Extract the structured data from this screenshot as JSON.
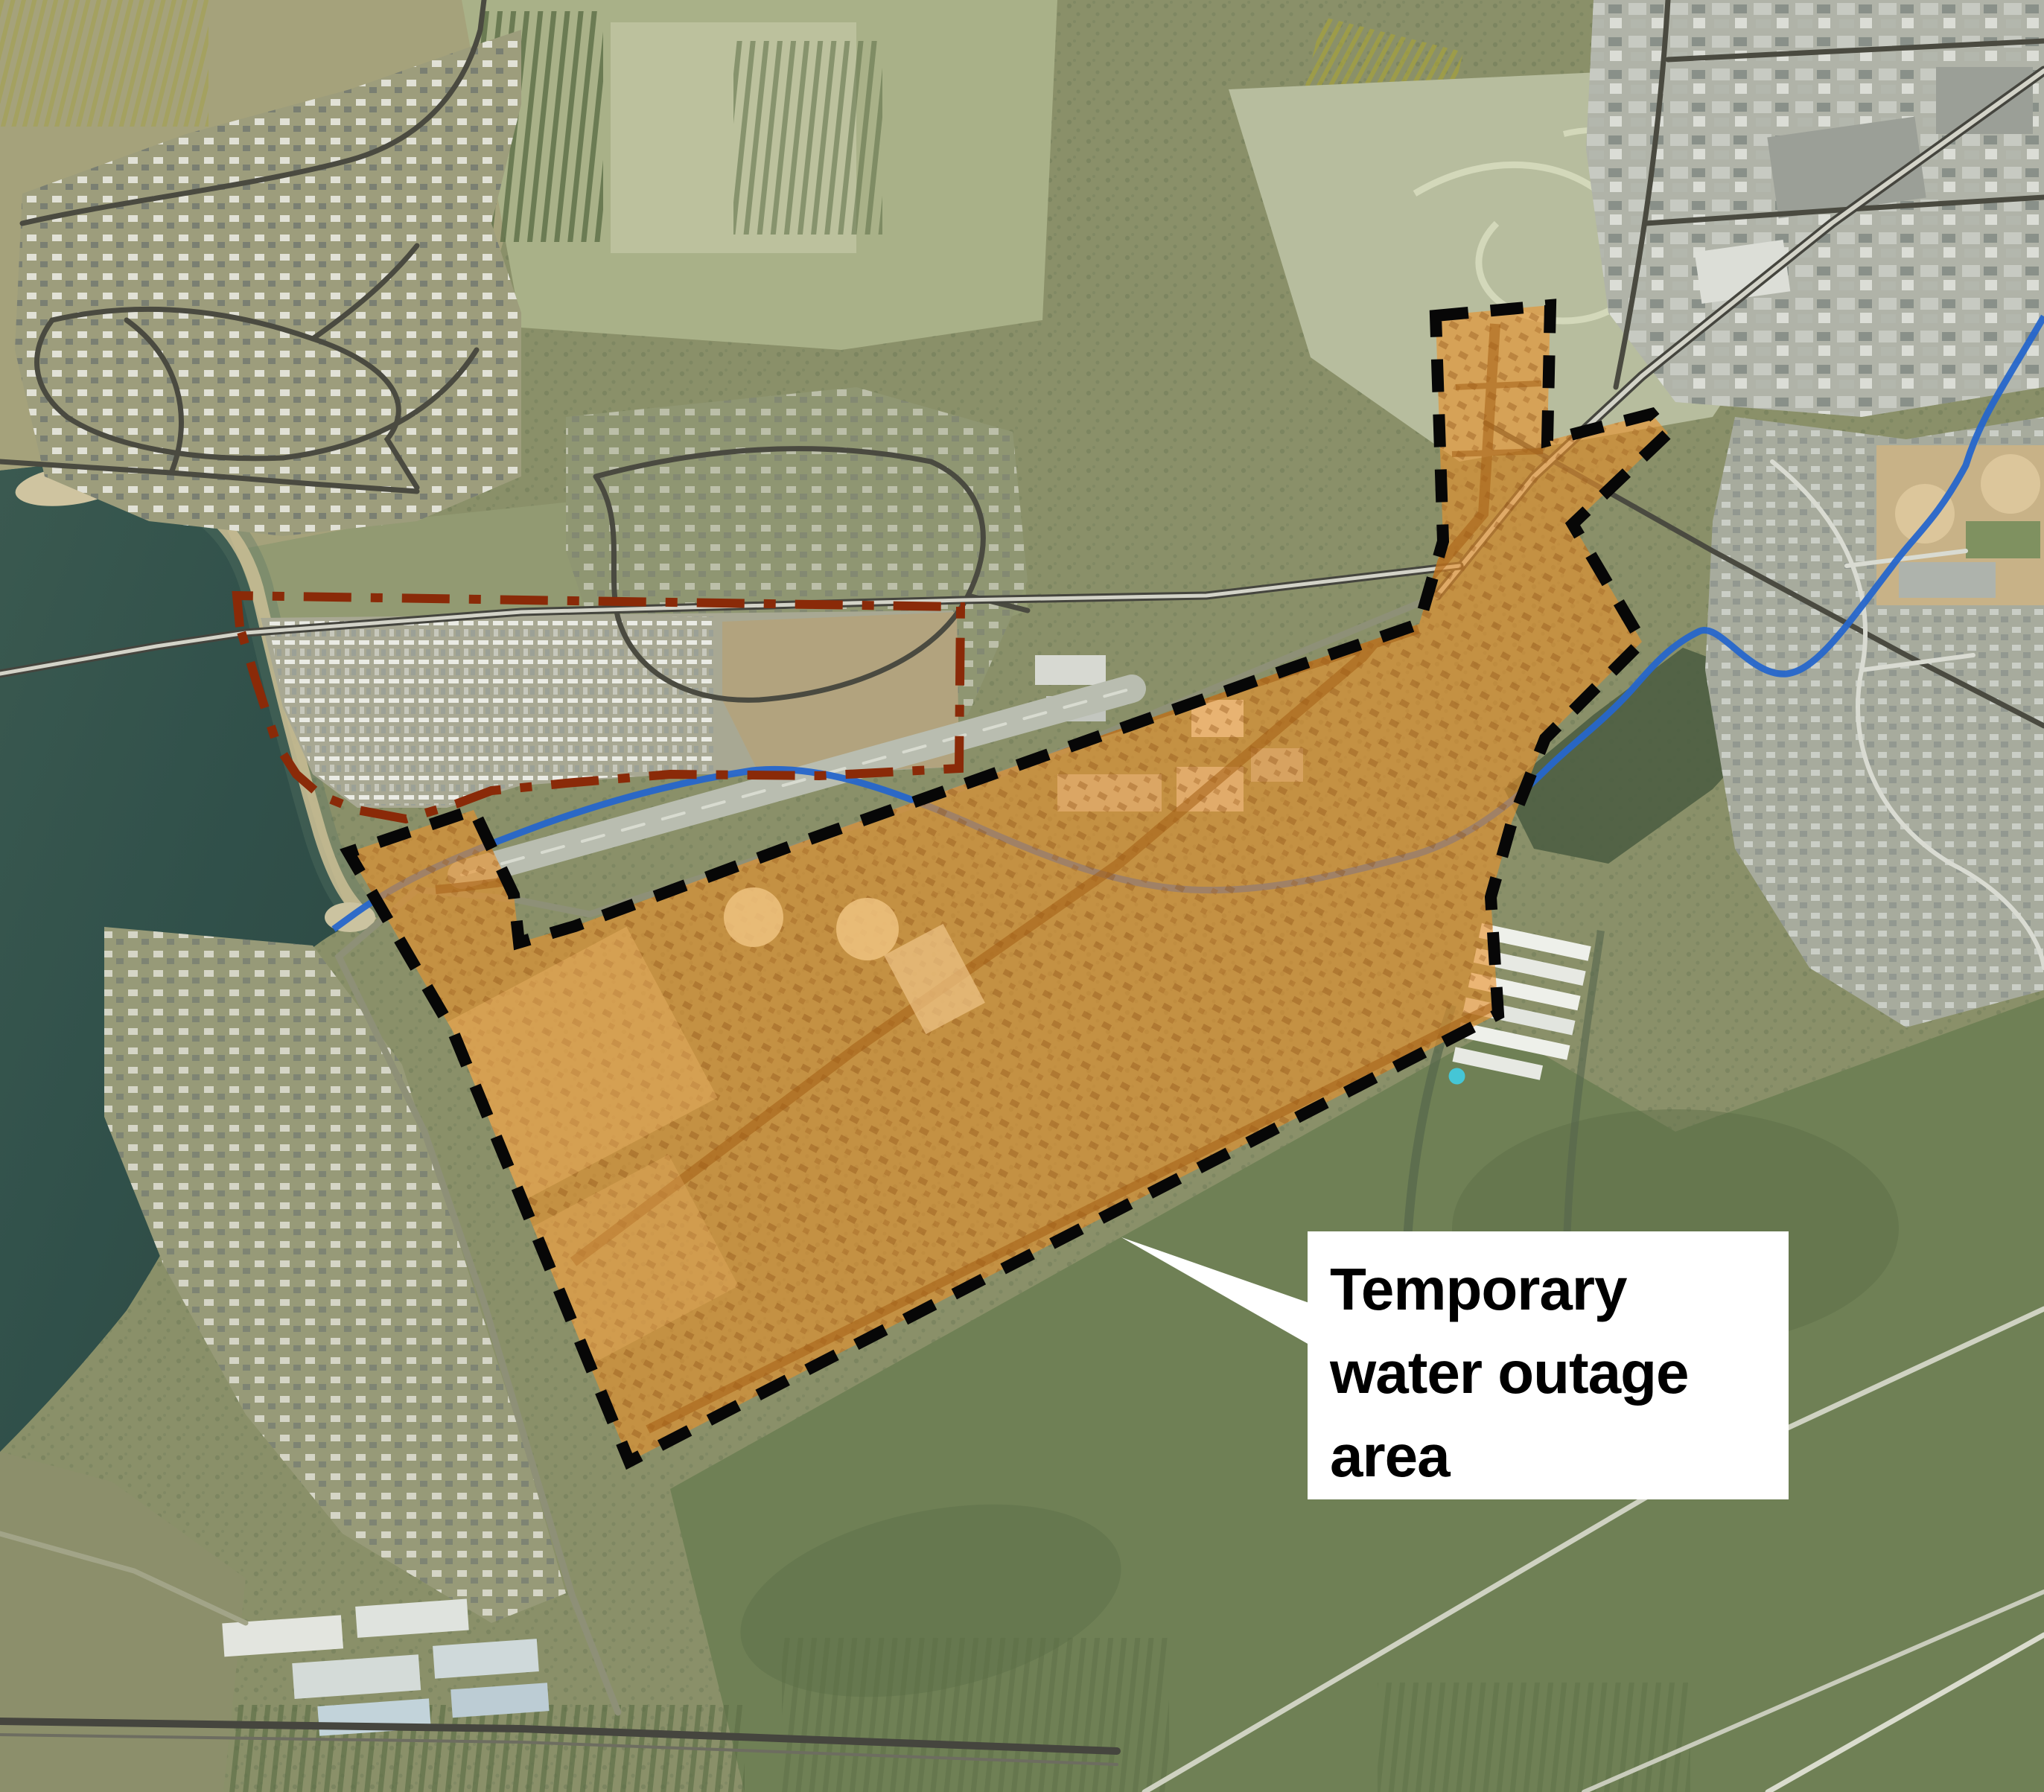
{
  "annotation": {
    "text": "Temporary water outage area",
    "lines": [
      "Temporary",
      "water outage",
      "area"
    ]
  },
  "colors": {
    "outage_fill": "#E8912C",
    "outage_border": "#070707",
    "restricted_boundary": "#8A2A08",
    "creek": "#2666CB",
    "lake": "#33524B",
    "label_background": "#FFFFFF",
    "label_text": "#000000"
  }
}
